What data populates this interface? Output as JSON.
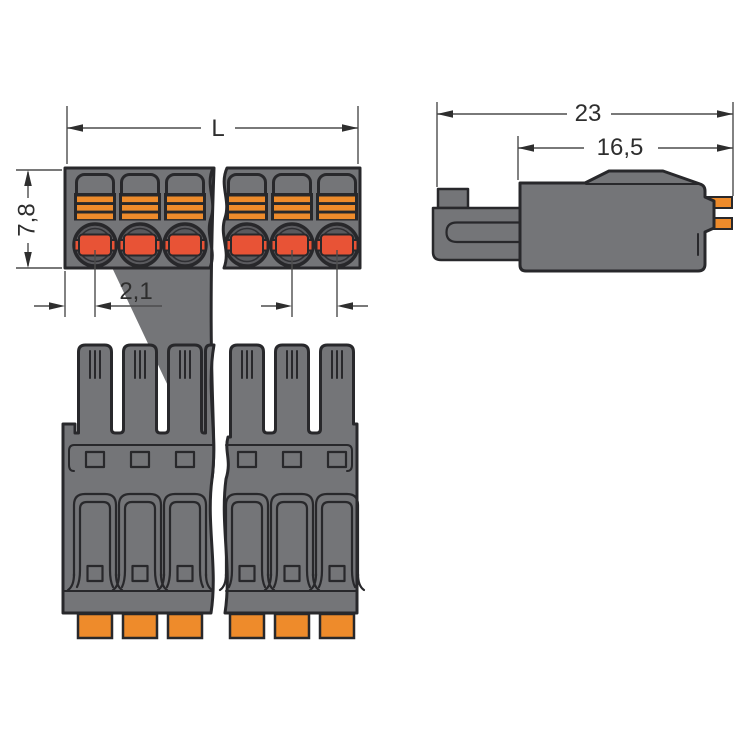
{
  "drawing": {
    "kind": "connector-technical-drawing",
    "poles_visible_per_segment": 3,
    "dimensions": {
      "top_view": {
        "length": "L",
        "height": "7,8",
        "edge_to_pole": "2,1"
      },
      "side_view": {
        "overall_depth": "23",
        "housing_depth": "16,5"
      }
    }
  },
  "colors": {
    "body": "#747578",
    "outline": "#28282B",
    "orange": "#EE8B2B",
    "plug": "#E85336",
    "socket": "#5A5A5E",
    "dim_line": "#4D4D4D",
    "dim_text": "#2E2E2E",
    "background": "#FFFFFF"
  }
}
